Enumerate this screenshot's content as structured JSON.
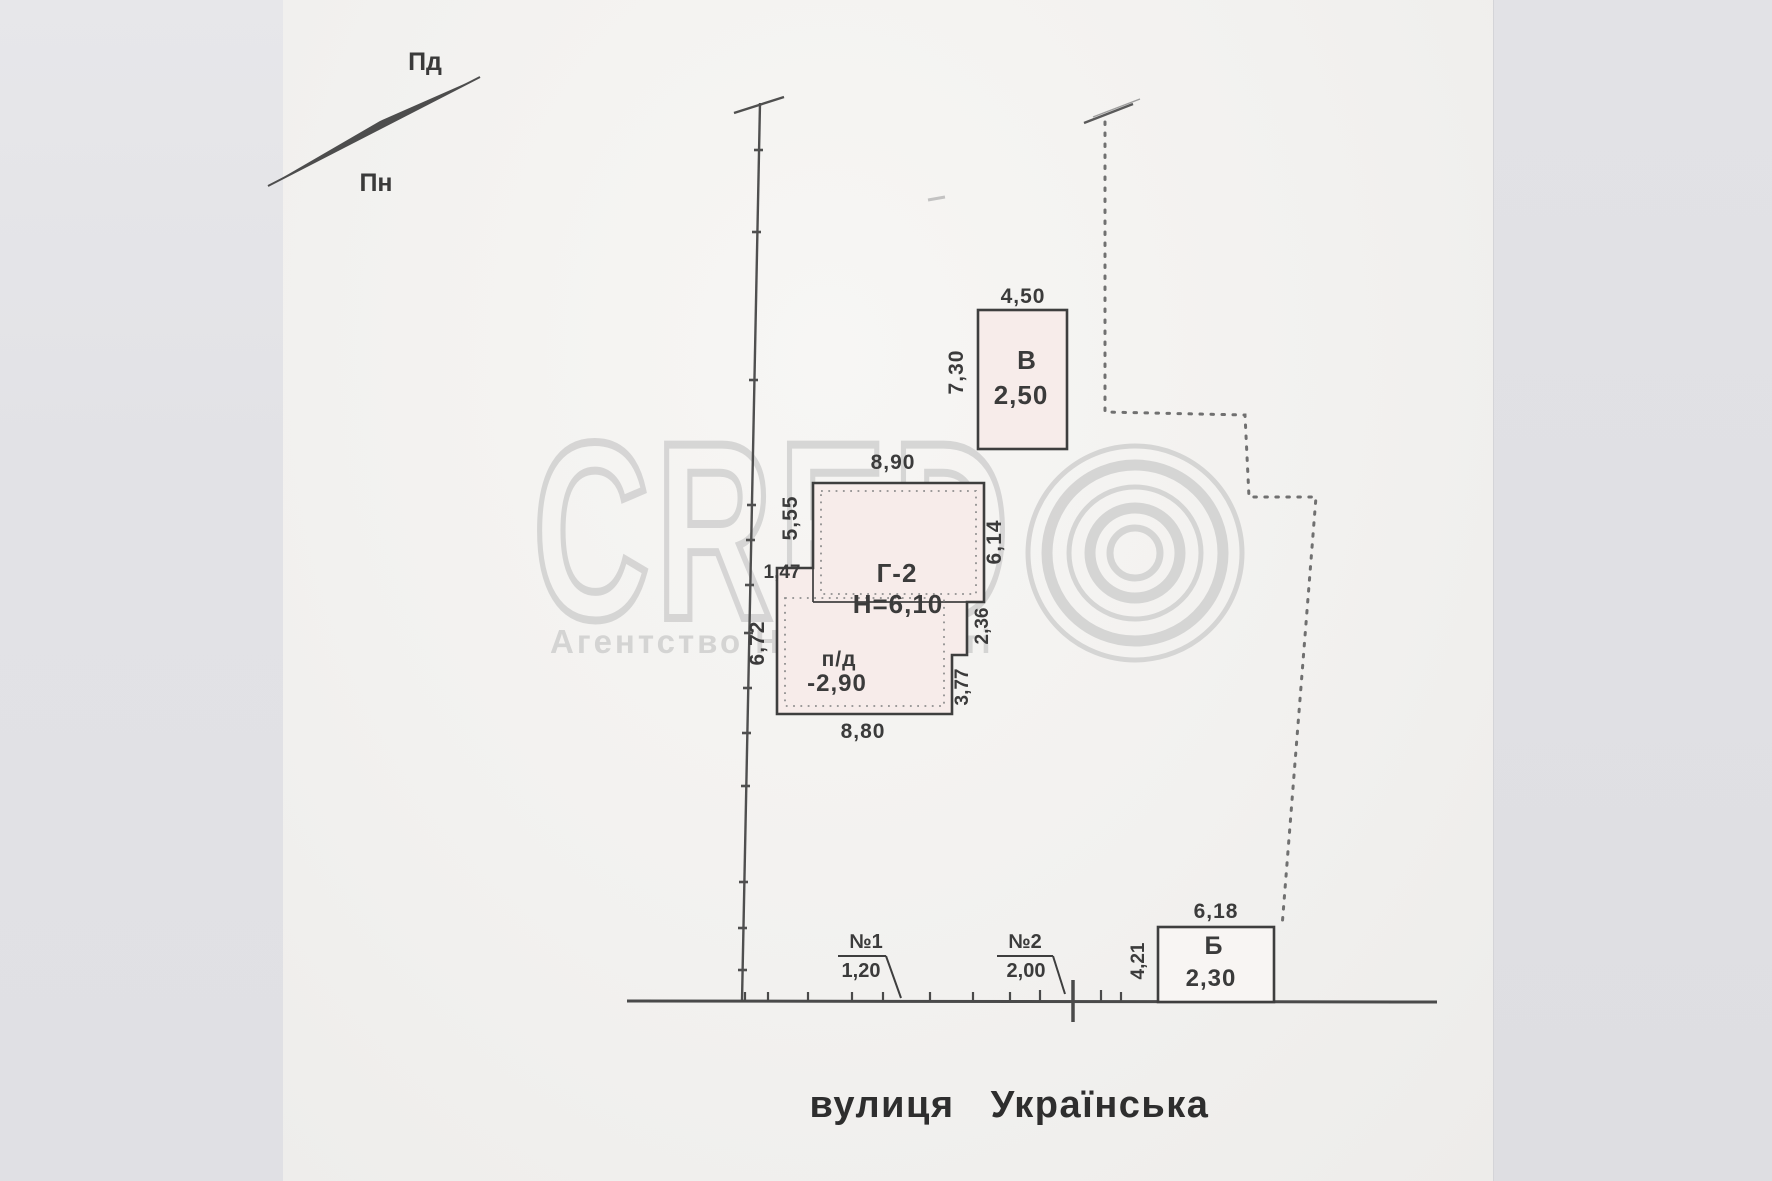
{
  "compass": {
    "south_label": "Пд",
    "north_label": "Пн"
  },
  "watermark": {
    "brand": "CRED",
    "tagline": "Агентство Нерухомості"
  },
  "plan": {
    "street": {
      "word": "вулиця",
      "name": "Українська"
    },
    "buildings": {
      "v": {
        "label": "В",
        "area": "2,50",
        "dim_top": "4,50",
        "dim_left": "7,30"
      },
      "g2": {
        "label": "Г-2",
        "height_note": "Н=6,10",
        "dim_top": "8,90",
        "dim_upper_left": "5,55",
        "dim_step_left": "1,47",
        "dim_right": "6,14",
        "dim_right_step1": "2,36",
        "dim_right_step2": "3,77",
        "dim_lower_left": "6,72",
        "dim_bottom": "8,80",
        "basement_label": "п/д",
        "basement_value": "-2,90"
      },
      "b": {
        "label": "Б",
        "area": "2,30",
        "dim_top": "6,18",
        "dim_left": "4,21"
      }
    },
    "gates": {
      "g1_label": "№1",
      "g1_value": "1,20",
      "g2_label": "№2",
      "g2_value": "2,00"
    }
  },
  "colors": {
    "ink": "#3e3e3e",
    "building_fill": "#f7ecea",
    "watermark_gray": "#c2c2c2",
    "paper": "#f2f1ef"
  }
}
